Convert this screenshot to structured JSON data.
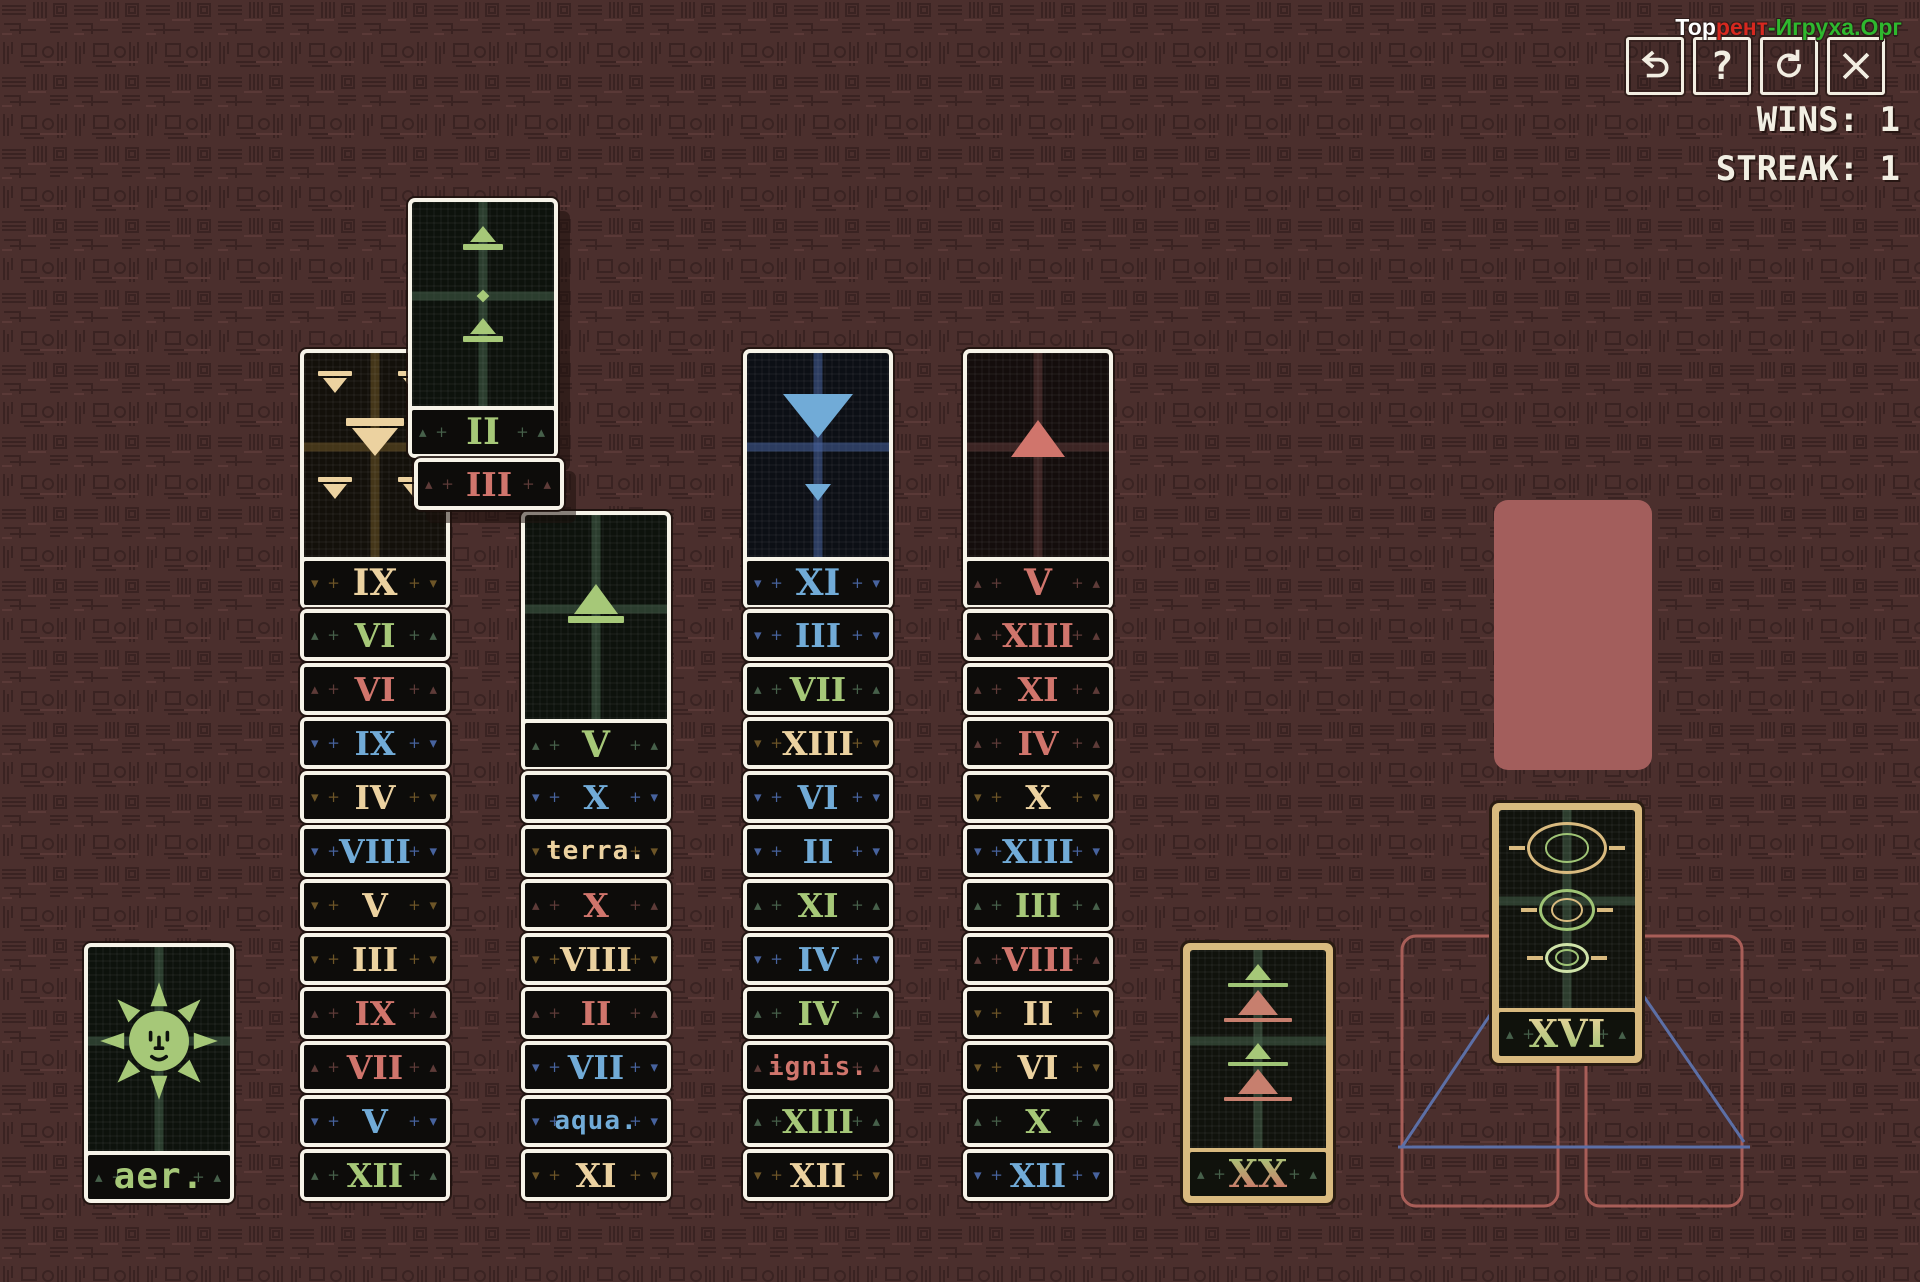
{
  "watermark": {
    "part_white": "Тор",
    "part_red": "рент",
    "part_green": "-Игруха.Орг"
  },
  "hud": {
    "wins": "WINS: 1",
    "streak": "STREAK: 1"
  },
  "toolbar": {
    "buttons": [
      {
        "name": "undo-button",
        "icon": "undo-arrow-icon"
      },
      {
        "name": "help-button",
        "icon": "question-mark-icon",
        "glyph": "?"
      },
      {
        "name": "restart-button",
        "icon": "restart-arrow-icon"
      },
      {
        "name": "close-button",
        "icon": "close-x-icon"
      }
    ]
  },
  "colors": {
    "background": "#4b2f2d",
    "card_border_white": "#f6f3e8",
    "band_background": "#0d0c0a",
    "gold_border": "#d9ba7f",
    "free_cell_fill": "#a35e5c",
    "foundation_red_outline": "#a85e58",
    "foundation_blue_outline": "#5c6fa6",
    "suit_green": "#a6c878",
    "suit_tan": "#ecd2a0",
    "suit_red": "#d0756c",
    "suit_blue": "#71abd7"
  },
  "board": {
    "free_cell": {
      "x": 1494,
      "y": 500,
      "w": 158,
      "h": 270
    },
    "floating_stack": {
      "x": 408,
      "y": 198,
      "cards": [
        {
          "numeral": "II",
          "suit": "green",
          "type": "full",
          "art": "earth-two"
        },
        {
          "numeral": "III",
          "suit": "red",
          "type": "band",
          "dx": 6
        }
      ]
    },
    "columns": [
      {
        "id": "pile-aer",
        "x": 84,
        "y": 943,
        "top_card": {
          "numeral": "aer.",
          "suit": "green",
          "art": "sun",
          "text": true
        },
        "bands": []
      },
      {
        "id": "column-1",
        "x": 300,
        "y": 349,
        "top_card": {
          "numeral": "IX",
          "suit": "tan",
          "art": "cups-nine"
        },
        "bands": [
          {
            "numeral": "VI",
            "suit": "green"
          },
          {
            "numeral": "VI",
            "suit": "red"
          },
          {
            "numeral": "IX",
            "suit": "blue"
          },
          {
            "numeral": "IV",
            "suit": "tan"
          },
          {
            "numeral": "VIII",
            "suit": "blue"
          },
          {
            "numeral": "V",
            "suit": "tan"
          },
          {
            "numeral": "III",
            "suit": "tan"
          },
          {
            "numeral": "IX",
            "suit": "red"
          },
          {
            "numeral": "VII",
            "suit": "red"
          },
          {
            "numeral": "V",
            "suit": "blue"
          },
          {
            "numeral": "XII",
            "suit": "green"
          }
        ]
      },
      {
        "id": "column-2",
        "x": 521,
        "y": 511,
        "top_card": {
          "numeral": "V",
          "suit": "green",
          "art": "earth-one"
        },
        "bands": [
          {
            "numeral": "X",
            "suit": "blue"
          },
          {
            "numeral": "terra.",
            "suit": "tan",
            "text": true
          },
          {
            "numeral": "X",
            "suit": "red"
          },
          {
            "numeral": "VIII",
            "suit": "tan"
          },
          {
            "numeral": "II",
            "suit": "red"
          },
          {
            "numeral": "VII",
            "suit": "blue"
          },
          {
            "numeral": "aqua.",
            "suit": "blue",
            "text": true
          },
          {
            "numeral": "XI",
            "suit": "tan"
          }
        ]
      },
      {
        "id": "column-3",
        "x": 743,
        "y": 349,
        "top_card": {
          "numeral": "XI",
          "suit": "blue",
          "art": "water-two"
        },
        "bands": [
          {
            "numeral": "III",
            "suit": "blue"
          },
          {
            "numeral": "VII",
            "suit": "green"
          },
          {
            "numeral": "XIII",
            "suit": "tan"
          },
          {
            "numeral": "VI",
            "suit": "blue"
          },
          {
            "numeral": "II",
            "suit": "blue"
          },
          {
            "numeral": "XI",
            "suit": "green"
          },
          {
            "numeral": "IV",
            "suit": "blue"
          },
          {
            "numeral": "IV",
            "suit": "green"
          },
          {
            "numeral": "ignis.",
            "suit": "red",
            "text": true
          },
          {
            "numeral": "XIII",
            "suit": "green"
          },
          {
            "numeral": "XII",
            "suit": "tan"
          }
        ]
      },
      {
        "id": "column-4",
        "x": 963,
        "y": 349,
        "top_card": {
          "numeral": "V",
          "suit": "red",
          "art": "fire-one"
        },
        "bands": [
          {
            "numeral": "XIII",
            "suit": "red"
          },
          {
            "numeral": "XI",
            "suit": "red"
          },
          {
            "numeral": "IV",
            "suit": "red"
          },
          {
            "numeral": "X",
            "suit": "tan"
          },
          {
            "numeral": "XIII",
            "suit": "blue"
          },
          {
            "numeral": "III",
            "suit": "green"
          },
          {
            "numeral": "VIII",
            "suit": "red"
          },
          {
            "numeral": "II",
            "suit": "tan"
          },
          {
            "numeral": "VI",
            "suit": "tan"
          },
          {
            "numeral": "X",
            "suit": "green"
          },
          {
            "numeral": "XII",
            "suit": "blue"
          }
        ]
      }
    ],
    "major_cards": [
      {
        "id": "card-xx",
        "numeral": "XX",
        "x": 1183,
        "y": 943,
        "art": "judgement",
        "grad": "grad-green-red"
      },
      {
        "id": "card-xvi",
        "numeral": "XVI",
        "x": 1492,
        "y": 803,
        "art": "tower",
        "grad": "grad-tan-green"
      }
    ]
  }
}
